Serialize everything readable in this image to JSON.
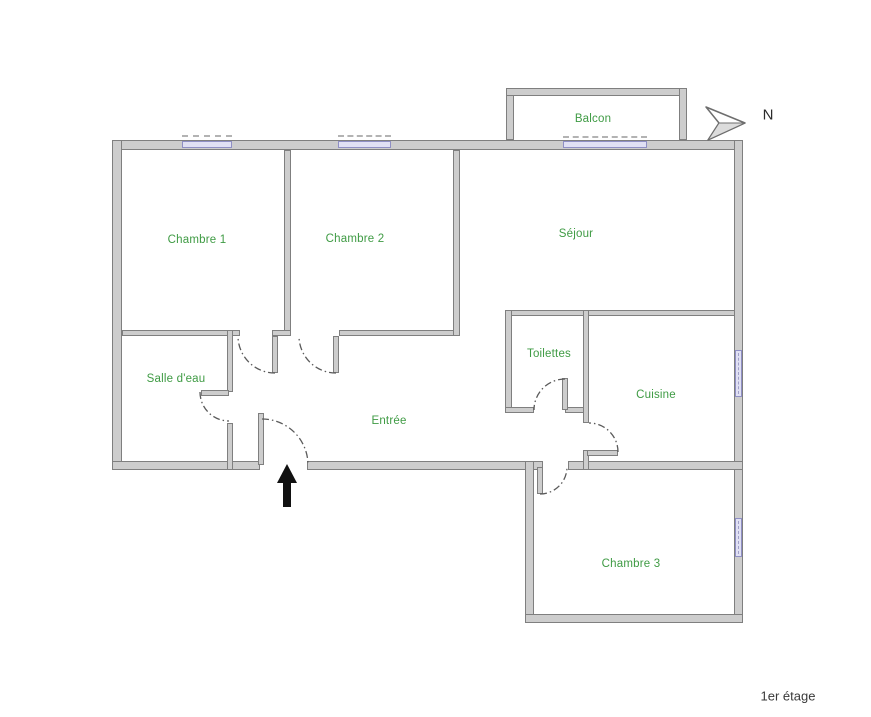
{
  "rooms": {
    "chambre1": "Chambre 1",
    "chambre2": "Chambre 2",
    "sejour": "Séjour",
    "balcon": "Balcon",
    "salle_deau": "Salle d'eau",
    "toilettes": "Toilettes",
    "entree": "Entrée",
    "cuisine": "Cuisine",
    "chambre3": "Chambre 3"
  },
  "compass": {
    "label": "N"
  },
  "floor": {
    "label": "1er étage"
  },
  "colors": {
    "room_label_green": "#3f9b44",
    "wall_fill": "#cdcdcd",
    "wall_outline": "#7f7f7f",
    "window_glass": "#e0e0f3",
    "window_edge": "#8f8fc4",
    "entrance_arrow": "#111111",
    "background": "#ffffff"
  },
  "icons": {
    "north_arrow": "north-arrow-icon",
    "entrance_arrow": "entrance-arrow-icon",
    "door_swing": "door-swing-arc"
  }
}
